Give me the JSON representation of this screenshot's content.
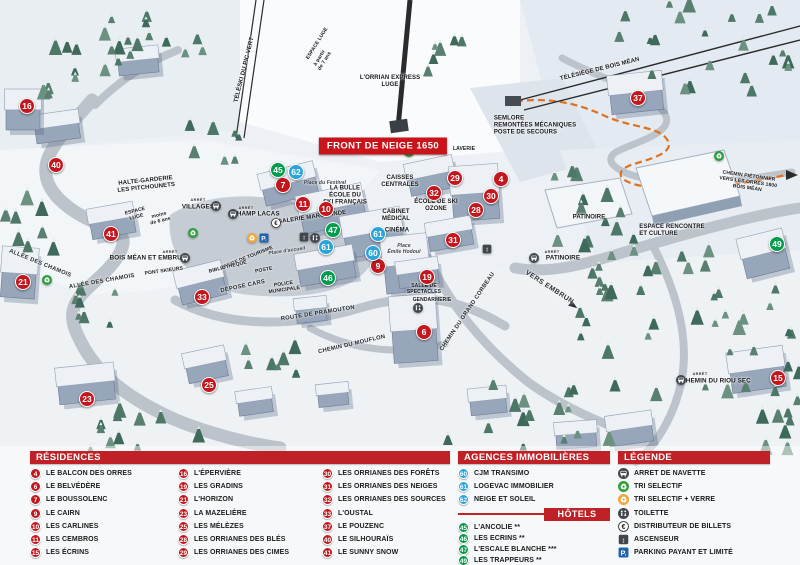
{
  "colors": {
    "residence": "#c4161d",
    "hotel": "#009c4b",
    "agence": "#2ba4da",
    "header": "#bf2127",
    "badge": "#c8151c",
    "pathOrange": "#e0721f"
  },
  "map": {
    "front_badge": "FRONT DE NEIGE 1650",
    "labels": [
      {
        "t": "ESPACE LUGE",
        "x": 318,
        "y": 44,
        "r": -58,
        "s": "micro"
      },
      {
        "t": "à partir\nde 7 ans",
        "x": 323,
        "y": 60,
        "r": -58,
        "s": "micro"
      },
      {
        "t": "TÉLÉSKI DU PIC VERT",
        "x": 245,
        "y": 70,
        "r": -76,
        "s": "tiny"
      },
      {
        "t": "L'ORRIAN EXPRESS\nLUGE",
        "x": 390,
        "y": 82,
        "r": 0,
        "s": "tiny"
      },
      {
        "t": "TÉLÉSIÈGE DE BOIS MÉAN",
        "x": 600,
        "y": 70,
        "r": -14,
        "s": "tiny"
      },
      {
        "t": "LAVERIE",
        "x": 464,
        "y": 150,
        "r": 0,
        "s": "micro"
      },
      {
        "t": "SEMLORE\nREMONTÉES MÉCANIQUES\nPOSTE DE SECOURS",
        "x": 535,
        "y": 126,
        "r": 0,
        "s": "tiny-left"
      },
      {
        "t": "HALTE-GARDERIE\nLES PITCHOUNETS",
        "x": 146,
        "y": 185,
        "r": -6,
        "s": "tiny"
      },
      {
        "t": "ESPACE\nLUGE",
        "x": 136,
        "y": 215,
        "r": -14,
        "s": "micro"
      },
      {
        "t": "moins\nde 6 ans",
        "x": 160,
        "y": 219,
        "r": -14,
        "s": "micro"
      },
      {
        "t": "ARRÊT",
        "x": 198,
        "y": 200,
        "r": 0,
        "s": "arret"
      },
      {
        "t": "VILLAGES",
        "x": 198,
        "y": 207,
        "r": 0,
        "s": "stop"
      },
      {
        "t": "ARRÊT",
        "x": 246,
        "y": 208,
        "r": 0,
        "s": "arret"
      },
      {
        "t": "CHAMP LACAS",
        "x": 256,
        "y": 214,
        "r": 0,
        "s": "stop"
      },
      {
        "t": "ARRÊT",
        "x": 170,
        "y": 252,
        "r": 0,
        "s": "arret"
      },
      {
        "t": "BOIS MÉAN ET EMBRUN",
        "x": 148,
        "y": 258,
        "r": 0,
        "s": "stop"
      },
      {
        "t": "PONT SKIEURS",
        "x": 164,
        "y": 272,
        "r": -8,
        "s": "micro"
      },
      {
        "t": "ALLÉE DES CHAMOIS",
        "x": 40,
        "y": 264,
        "r": 22,
        "s": "road"
      },
      {
        "t": "ALLÉE DES CHAMOIS",
        "x": 102,
        "y": 282,
        "r": -10,
        "s": "road"
      },
      {
        "t": "OFFICE DE TOURISME",
        "x": 247,
        "y": 259,
        "r": -22,
        "s": "micro"
      },
      {
        "t": "BIBLIOTHÈQUE",
        "x": 228,
        "y": 268,
        "r": -14,
        "s": "micro"
      },
      {
        "t": "POSTE",
        "x": 264,
        "y": 271,
        "r": -10,
        "s": "micro"
      },
      {
        "t": "DÉPOSE CARS",
        "x": 243,
        "y": 287,
        "r": -12,
        "s": "road"
      },
      {
        "t": "POLICE\nMUNICIPALE",
        "x": 284,
        "y": 288,
        "r": -8,
        "s": "micro"
      },
      {
        "t": "Place d'accueil",
        "x": 287,
        "y": 252,
        "r": -8,
        "s": "place-s"
      },
      {
        "t": "Place du Festival",
        "x": 325,
        "y": 184,
        "r": 0,
        "s": "place-s"
      },
      {
        "t": "LA BULLE\nÉCOLE DU\nSKI FRANÇAIS",
        "x": 345,
        "y": 196,
        "r": 0,
        "s": "tiny"
      },
      {
        "t": "GALERIE MARCHANDE",
        "x": 312,
        "y": 218,
        "r": -8,
        "s": "tiny"
      },
      {
        "t": "CAISSES\nCENTRALES",
        "x": 400,
        "y": 182,
        "r": 0,
        "s": "tiny"
      },
      {
        "t": "CABINET\nMÉDICAL",
        "x": 396,
        "y": 216,
        "r": 0,
        "s": "tiny"
      },
      {
        "t": "CINÉMA",
        "x": 397,
        "y": 231,
        "r": 0,
        "s": "tiny"
      },
      {
        "t": "Place\nÉmile Hodoul",
        "x": 404,
        "y": 250,
        "r": 0,
        "s": "place-s"
      },
      {
        "t": "ÉCOLE DE SKI\nOZONE",
        "x": 436,
        "y": 206,
        "r": 0,
        "s": "tiny"
      },
      {
        "t": "SALLE DE\nSPECTACLES",
        "x": 424,
        "y": 290,
        "r": 0,
        "s": "micro"
      },
      {
        "t": "GENDARMERIE",
        "x": 432,
        "y": 301,
        "r": 0,
        "s": "micro"
      },
      {
        "t": "PATINOIRE",
        "x": 589,
        "y": 218,
        "r": 0,
        "s": "tiny"
      },
      {
        "t": "ARRÊT",
        "x": 552,
        "y": 252,
        "r": 0,
        "s": "arret"
      },
      {
        "t": "PATINOIRE",
        "x": 563,
        "y": 258,
        "r": 0,
        "s": "stop"
      },
      {
        "t": "VERS EMBRUN",
        "x": 549,
        "y": 288,
        "r": 33,
        "s": "road-b"
      },
      {
        "t": "ESPACE RENCONTRE\nET CULTURE",
        "x": 672,
        "y": 231,
        "r": 0,
        "s": "tiny-left"
      },
      {
        "t": "CHEMIN PIÉTONNIER\nVERS LES ORRES 1800\nBOIS MÉAN",
        "x": 748,
        "y": 183,
        "r": 8,
        "s": "micro"
      },
      {
        "t": "ARRÊT",
        "x": 700,
        "y": 374,
        "r": 0,
        "s": "arret"
      },
      {
        "t": "CHEMIN DU RIOU SEC",
        "x": 716,
        "y": 381,
        "r": 0,
        "s": "stop"
      },
      {
        "t": "ROUTE DE PRAMOUTON",
        "x": 318,
        "y": 314,
        "r": -9,
        "s": "road"
      },
      {
        "t": "CHEMIN DU MOUFLON",
        "x": 352,
        "y": 345,
        "r": -13,
        "s": "road"
      },
      {
        "t": "CHEMIN DU GRAND CORBEAU",
        "x": 468,
        "y": 312,
        "r": -56,
        "s": "road"
      }
    ],
    "markers": [
      {
        "n": "16",
        "t": "res",
        "x": 27,
        "y": 106
      },
      {
        "n": "40",
        "t": "res",
        "x": 56,
        "y": 165
      },
      {
        "n": "41",
        "t": "res",
        "x": 111,
        "y": 234
      },
      {
        "n": "21",
        "t": "res",
        "x": 23,
        "y": 282
      },
      {
        "n": "33",
        "t": "res",
        "x": 202,
        "y": 297
      },
      {
        "n": "23",
        "t": "res",
        "x": 87,
        "y": 399
      },
      {
        "n": "25",
        "t": "res",
        "x": 209,
        "y": 385
      },
      {
        "n": "7",
        "t": "res",
        "x": 283,
        "y": 185
      },
      {
        "n": "11",
        "t": "res",
        "x": 303,
        "y": 204
      },
      {
        "n": "10",
        "t": "res",
        "x": 326,
        "y": 209
      },
      {
        "n": "9",
        "t": "res",
        "x": 378,
        "y": 266
      },
      {
        "n": "19",
        "t": "res",
        "x": 427,
        "y": 277
      },
      {
        "n": "6",
        "t": "res",
        "x": 424,
        "y": 332
      },
      {
        "n": "29",
        "t": "res",
        "x": 455,
        "y": 178
      },
      {
        "n": "32",
        "t": "res",
        "x": 434,
        "y": 193
      },
      {
        "n": "28",
        "t": "res",
        "x": 476,
        "y": 210
      },
      {
        "n": "31",
        "t": "res",
        "x": 453,
        "y": 240
      },
      {
        "n": "4",
        "t": "res",
        "x": 501,
        "y": 179
      },
      {
        "n": "30",
        "t": "res",
        "x": 491,
        "y": 196
      },
      {
        "n": "37",
        "t": "res",
        "x": 638,
        "y": 98
      },
      {
        "n": "15",
        "t": "res",
        "x": 778,
        "y": 378
      },
      {
        "n": "45",
        "t": "hot",
        "x": 278,
        "y": 170
      },
      {
        "n": "47",
        "t": "hot",
        "x": 333,
        "y": 230
      },
      {
        "n": "46",
        "t": "hot",
        "x": 328,
        "y": 278
      },
      {
        "n": "49",
        "t": "hot",
        "x": 777,
        "y": 244
      },
      {
        "n": "62",
        "t": "ag",
        "x": 296,
        "y": 172
      },
      {
        "n": "61",
        "t": "ag",
        "x": 326,
        "y": 247
      },
      {
        "n": "61",
        "t": "ag",
        "x": 378,
        "y": 234
      },
      {
        "n": "60",
        "t": "ag",
        "x": 373,
        "y": 253
      }
    ],
    "icons": [
      {
        "t": "bus",
        "x": 216,
        "y": 206
      },
      {
        "t": "bus",
        "x": 233,
        "y": 214
      },
      {
        "t": "bus",
        "x": 185,
        "y": 258
      },
      {
        "t": "bus",
        "x": 534,
        "y": 258
      },
      {
        "t": "bus",
        "x": 681,
        "y": 380
      },
      {
        "t": "recycle",
        "x": 193,
        "y": 233
      },
      {
        "t": "recycle",
        "x": 47,
        "y": 280
      },
      {
        "t": "recycle",
        "x": 719,
        "y": 156
      },
      {
        "t": "recycle",
        "x": 409,
        "y": 152
      },
      {
        "t": "recycle-glass",
        "x": 252,
        "y": 238
      },
      {
        "t": "parking",
        "x": 264,
        "y": 238
      },
      {
        "t": "euro",
        "x": 276,
        "y": 223
      },
      {
        "t": "elevator",
        "x": 304,
        "y": 237
      },
      {
        "t": "wc",
        "x": 315,
        "y": 238
      },
      {
        "t": "wc",
        "x": 418,
        "y": 308
      },
      {
        "t": "elevator",
        "x": 487,
        "y": 249
      }
    ]
  },
  "legend": {
    "residences": {
      "title": "RÉSIDENCES",
      "items": [
        {
          "n": "4",
          "label": "LE BALCON DES ORRES"
        },
        {
          "n": "6",
          "label": "LE BELVÉDÈRE"
        },
        {
          "n": "7",
          "label": "LE BOUSSOLENC"
        },
        {
          "n": "9",
          "label": "LE CAIRN"
        },
        {
          "n": "10",
          "label": "LES CARLINES"
        },
        {
          "n": "11",
          "label": "LES CEMBROS"
        },
        {
          "n": "15",
          "label": "LES ÉCRINS"
        },
        {
          "n": "16",
          "label": "L'ÉPERVIÈRE"
        },
        {
          "n": "19",
          "label": "LES GRADINS"
        },
        {
          "n": "21",
          "label": "L'HORIZON"
        },
        {
          "n": "23",
          "label": "LA MAZELIÈRE"
        },
        {
          "n": "25",
          "label": "LES MÉLÈZES"
        },
        {
          "n": "28",
          "label": "LES ORRIANES DES BLÉS"
        },
        {
          "n": "29",
          "label": "LES ORRIANES DES CIMES"
        },
        {
          "n": "30",
          "label": "LES ORRIANES DES FORÊTS"
        },
        {
          "n": "31",
          "label": "LES ORRIANES DES NEIGES"
        },
        {
          "n": "32",
          "label": "LES ORRIANES DES SOURCES"
        },
        {
          "n": "33",
          "label": "L'OUSTAL"
        },
        {
          "n": "37",
          "label": "LE POUZENC"
        },
        {
          "n": "40",
          "label": "LE SILHOURAÏS"
        },
        {
          "n": "41",
          "label": "LE SUNNY SNOW"
        }
      ]
    },
    "agences": {
      "title": "AGENCES IMMOBILIÈRES",
      "items": [
        {
          "n": "60",
          "label": "CJM TRANSIMO"
        },
        {
          "n": "61",
          "label": "LOGEVAC IMMOBILIER"
        },
        {
          "n": "62",
          "label": "NEIGE ET SOLEIL"
        }
      ]
    },
    "hotels": {
      "title": "HÔTELS",
      "items": [
        {
          "n": "45",
          "label": "L'ANCOLIE **"
        },
        {
          "n": "46",
          "label": "LES ECRINS **"
        },
        {
          "n": "47",
          "label": "L'ESCALE BLANCHE ***"
        },
        {
          "n": "49",
          "label": "LES TRAPPEURS **"
        }
      ]
    },
    "legende": {
      "title": "LÉGENDE",
      "items": [
        {
          "icon": "bus",
          "label": "ARRET DE NAVETTE"
        },
        {
          "icon": "recycle",
          "label": "TRI SELECTIF"
        },
        {
          "icon": "recycle-glass",
          "label": "TRI SELECTIF + VERRE"
        },
        {
          "icon": "wc",
          "label": "TOILETTE"
        },
        {
          "icon": "euro",
          "label": "DISTRIBUTEUR DE BILLETS"
        },
        {
          "icon": "elevator",
          "label": "ASCENSEUR"
        },
        {
          "icon": "parking",
          "label": "PARKING PAYANT ET LIMITÉ"
        }
      ]
    }
  }
}
